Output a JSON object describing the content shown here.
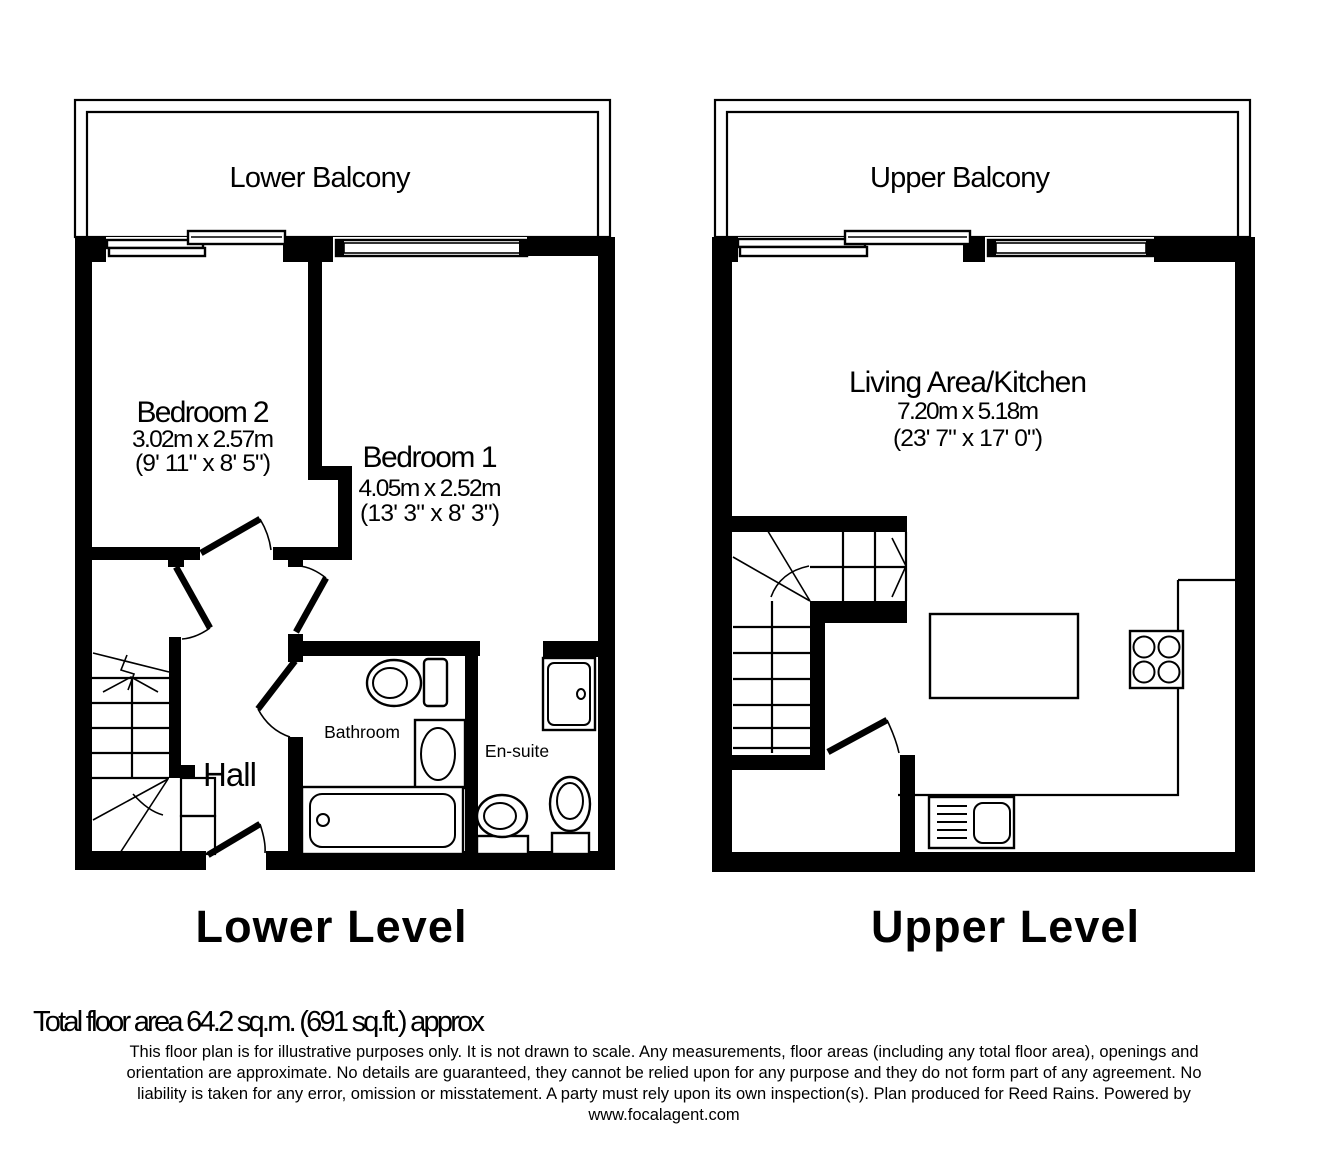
{
  "plan": {
    "lower": {
      "balcony_label": "Lower Balcony",
      "level_label": "Lower Level",
      "bedroom2": {
        "name": "Bedroom 2",
        "metric": "3.02m x 2.57m",
        "imperial": "(9' 11\" x 8' 5\")"
      },
      "bedroom1": {
        "name": "Bedroom 1",
        "metric": "4.05m x 2.52m",
        "imperial": "(13' 3\" x 8' 3\")"
      },
      "hall_label": "Hall",
      "bathroom_label": "Bathroom",
      "ensuite_label": "En-suite"
    },
    "upper": {
      "balcony_label": "Upper Balcony",
      "level_label": "Upper Level",
      "living": {
        "name": "Living Area/Kitchen",
        "metric": "7.20m x 5.18m",
        "imperial": "(23' 7\" x 17' 0\")"
      }
    }
  },
  "footer": {
    "total_area": "Total floor area 64.2 sq.m. (691 sq.ft.) approx",
    "disclaimer": [
      "This floor plan is for illustrative purposes only. It is not drawn to scale. Any measurements, floor areas (including any total floor area), openings and",
      "orientation are approximate. No details are guaranteed, they cannot be relied upon for any purpose and they do not form part of any agreement. No",
      "liability is taken for any error, omission or misstatement. A party must rely upon its own inspection(s). Plan produced for Reed Rains. Powered by",
      "www.focalagent.com"
    ]
  },
  "icons": [
    "toilet-icon",
    "sink-icon",
    "bath-icon",
    "shower-icon",
    "staircase-icon",
    "hob-icon",
    "kitchen-sink-icon",
    "island-icon",
    "door-swing-icon",
    "window-icon"
  ],
  "colors": {
    "wall": "#000000",
    "background": "#ffffff"
  }
}
